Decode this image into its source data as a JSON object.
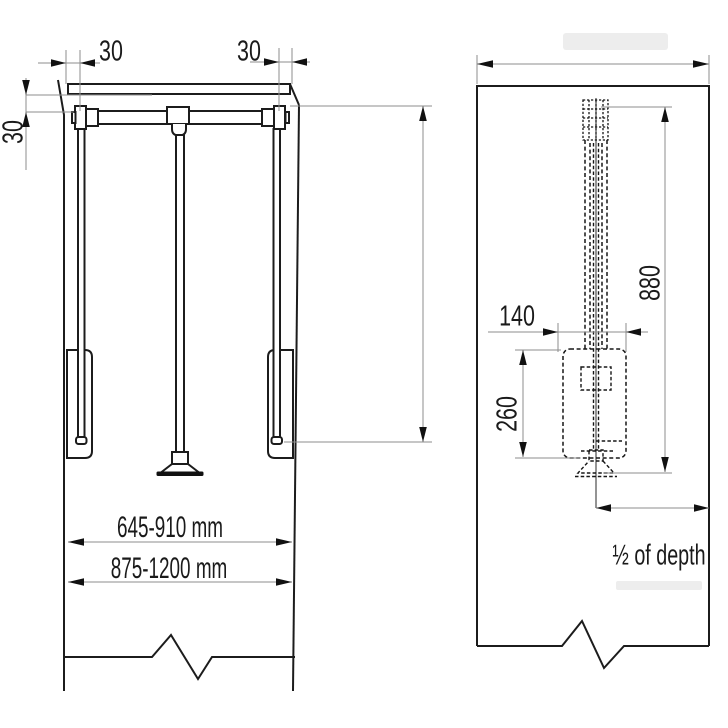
{
  "front_view": {
    "dim_top_left_offset": "30",
    "dim_top_right_offset": "30",
    "dim_side_drop": "30",
    "dim_inner_width_range": "645-910 mm",
    "dim_outer_width_range": "875-1200 mm"
  },
  "side_view": {
    "dim_travel_height": "880",
    "dim_unit_width": "140",
    "dim_unit_height": "260",
    "dim_mount_depth": "½ of depth"
  },
  "colors": {
    "line": "#1c1c1c",
    "dim_line": "#8e8e8e",
    "arrow": "#111111",
    "background": "#ffffff"
  }
}
